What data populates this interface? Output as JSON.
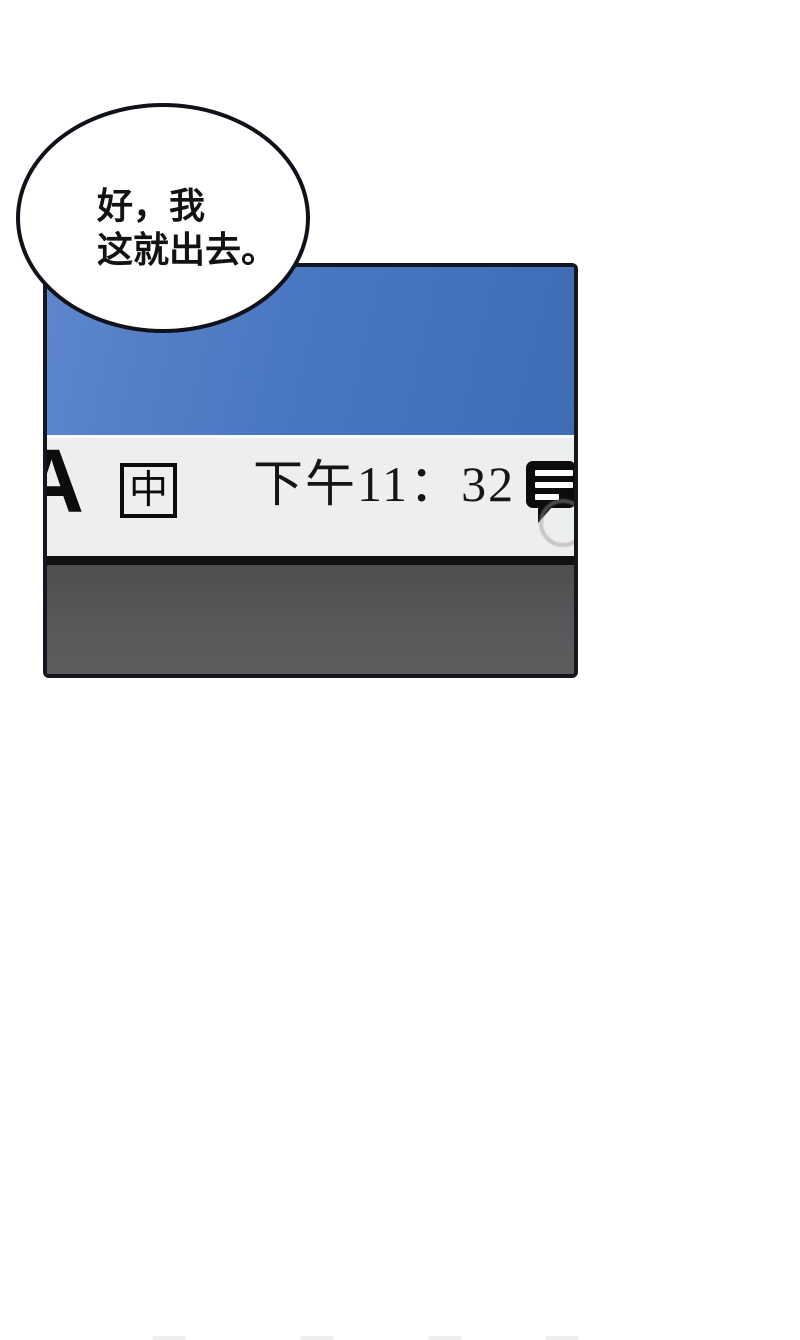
{
  "colors": {
    "page-bg": "#ffffff",
    "panel-border": "#14171e",
    "desktop-blue-left": "#5d86cd",
    "desktop-blue-right": "#3e6db5",
    "taskbar-bg": "#edeeee",
    "taskbar-highlight": "#f8fcfd",
    "separator-black": "#101010",
    "bezel-gray": "#58585a",
    "ink-black": "#0c0c0c",
    "bubble-fill": "#ffffff",
    "bubble-border": "#0f1319"
  },
  "speech_bubble": {
    "line1": "好，我",
    "line2": "这就出去。"
  },
  "panel": {
    "taskbar": {
      "ime_letter": "A",
      "ime_lang": "中",
      "time": "下午11：32"
    },
    "icons": {
      "notification": "message-lines-icon",
      "sketch": "circle-sketch-overlay"
    }
  }
}
